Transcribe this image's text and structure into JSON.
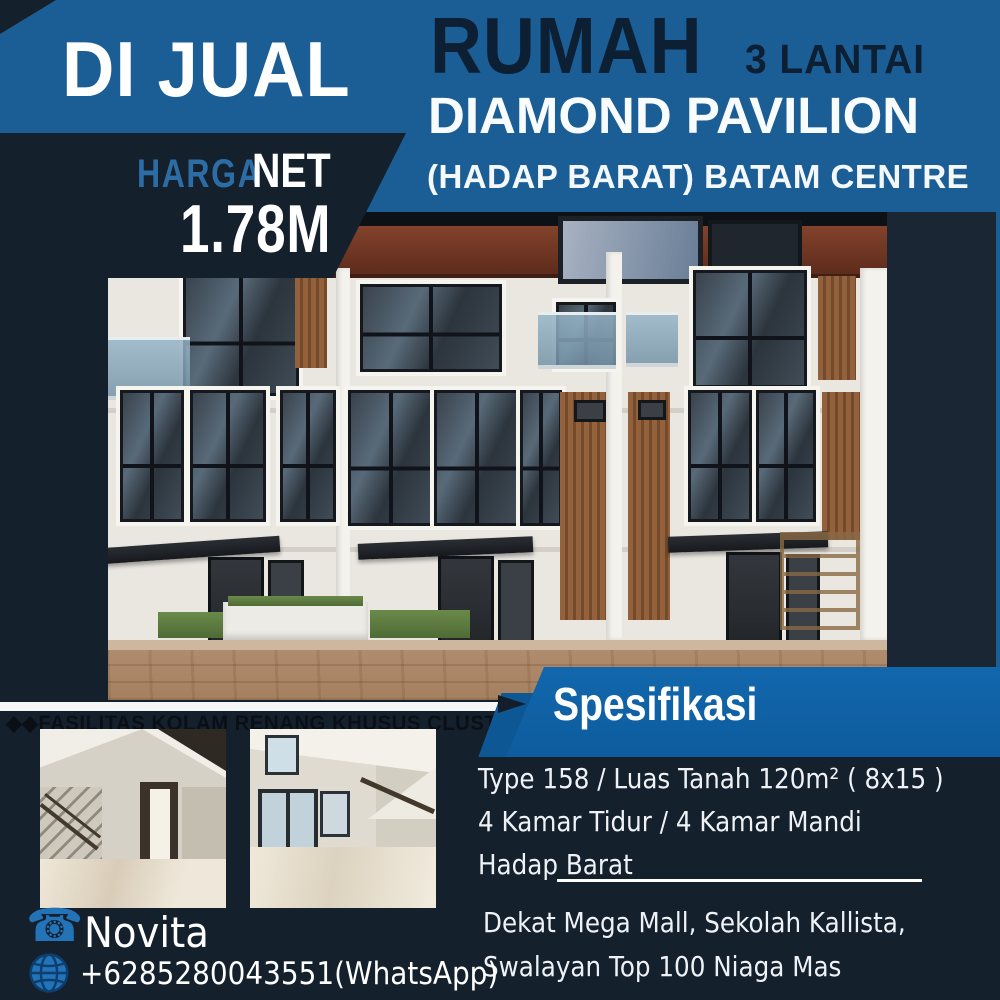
{
  "badge": {
    "label": "DI JUAL"
  },
  "price": {
    "label_primary": "HARGA",
    "label_secondary": "NET",
    "value": "1.78M"
  },
  "header": {
    "title": "RUMAH",
    "floors": "3 LANTAI",
    "project": "DIAMOND PAVILION",
    "location": "(HADAP BARAT) BATAM CENTRE"
  },
  "facility_note": "◆◆FASILITAS KOLAM RENANG KHUSUS CLUSTER",
  "specs": {
    "heading": "Spesifikasi",
    "lines": [
      "Type 158 / Luas Tanah 120m² ( 8x15 )",
      "4 Kamar Tidur / 4 Kamar Mandi",
      "Hadap Barat"
    ],
    "nearby": [
      "Dekat Mega Mall, Sekolah Kallista,",
      "Swalayan Top 100 Niaga Mas"
    ]
  },
  "contact": {
    "name": "Novita",
    "phone": "+6285280043551(WhatsApp)"
  },
  "icons": {
    "telephone": "☎",
    "globe": "globe-grid"
  },
  "colors": {
    "top_banner_blue": "#1a5e95",
    "spec_banner_blue": "#1267ac",
    "background_navy": "#15202d",
    "harga_text_blue": "#2d6da6",
    "title_text_navy": "#0c1f33",
    "contact_icon_blue": "#2273b8"
  }
}
